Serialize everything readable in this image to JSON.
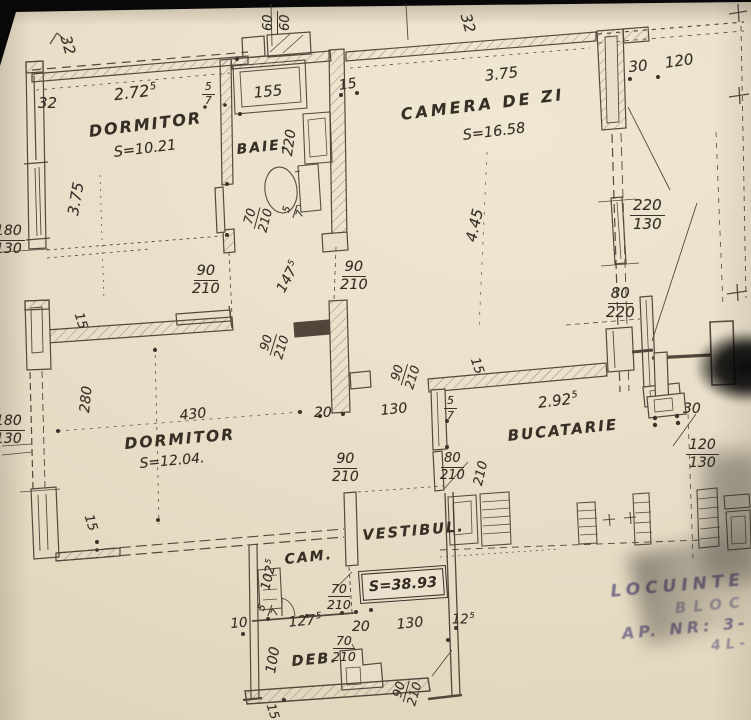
{
  "photo": {
    "paper_color": "#e9dfc9",
    "ink_color": "#463c30",
    "stamp_ink": "#4d4476"
  },
  "rooms": {
    "dormitor1": {
      "name": "DORMITOR",
      "area": "S=10.21"
    },
    "baie": {
      "name": "BAIE."
    },
    "camera_de_zi": {
      "name": "CAMERA DE ZI",
      "area": "S=16.58"
    },
    "dormitor2": {
      "name": "DORMITOR",
      "area": "S=12.04."
    },
    "bucatarie": {
      "name": "BUCATARIE"
    },
    "vestibul": {
      "name": "VESTIBUL."
    },
    "cam": {
      "name": "CAM."
    },
    "deb": {
      "name": "DEB."
    }
  },
  "total_area": {
    "label": "S=38.93"
  },
  "stamp": {
    "line1": "LOCUINTE",
    "line2": "BLOC",
    "line3": "AP. NR: 3-",
    "line4": "4L-"
  },
  "dims": {
    "wall32_rot_left": "32",
    "wall32_left": "32",
    "w272": {
      "base": "2.72",
      "sup": "5"
    },
    "door5_7_baie": {
      "num": "5",
      "den": "7"
    },
    "len155": "155",
    "len15_baie": "15",
    "len220_baie": "220",
    "shaft60": {
      "num": "60",
      "den": "60"
    },
    "len375_left": "3.75",
    "win180_130_top": {
      "num": "180",
      "den": "130"
    },
    "door70_210_baie": {
      "num": "70",
      "den": "210"
    },
    "small5_7_baie": {
      "num": "5",
      "den": "7"
    },
    "wall32_rot_mid": "32",
    "len375_camera": "3.75",
    "len30_top": "30",
    "len120_top": "120",
    "len445_camera": "4.45",
    "win220_130": {
      "num": "220",
      "den": "130"
    },
    "win80_220": {
      "num": "80",
      "den": "220"
    },
    "door90_210_a": {
      "num": "90",
      "den": "210"
    },
    "w147": {
      "base": "147",
      "sup": "5"
    },
    "door90_210_b": {
      "num": "90",
      "den": "210"
    },
    "len15_hall": "15",
    "door90_210_c": {
      "num": "90",
      "den": "210"
    },
    "len280": "280",
    "win180_130_bottom": {
      "num": "180",
      "den": "130"
    },
    "len430": "430",
    "len20_hall": "20",
    "door90_210_d": {
      "num": "90",
      "den": "210"
    },
    "door90_210_e": {
      "num": "90",
      "den": "210"
    },
    "len130_hall": "130",
    "len15_bucatarie": "15",
    "w292": {
      "base": "2.92",
      "sup": "5"
    },
    "door5_7_bucatarie": {
      "num": "5",
      "den": "7"
    },
    "door80_210": {
      "num": "80",
      "den": "210"
    },
    "len210_bucatarie": "210",
    "len30_bucatarie": "30",
    "win120_130": {
      "num": "120",
      "den": "130"
    },
    "len15_dormitor2": "15",
    "w102": {
      "base": "102",
      "sup": "5"
    },
    "door70_210_cam": {
      "num": "70",
      "den": "210"
    },
    "small5_7_cam": {
      "num": "5",
      "den": "7"
    },
    "len10_deb": "10",
    "w127": {
      "base": "127",
      "sup": "5"
    },
    "len20_deb": "20",
    "door70_210_deb": {
      "num": "70",
      "den": "210"
    },
    "len130_deb": "130",
    "w12": {
      "base": "12",
      "sup": "5"
    },
    "len100_deb": "100",
    "door90_210_deb": {
      "num": "90",
      "den": "210"
    },
    "len15_deb": "15"
  }
}
